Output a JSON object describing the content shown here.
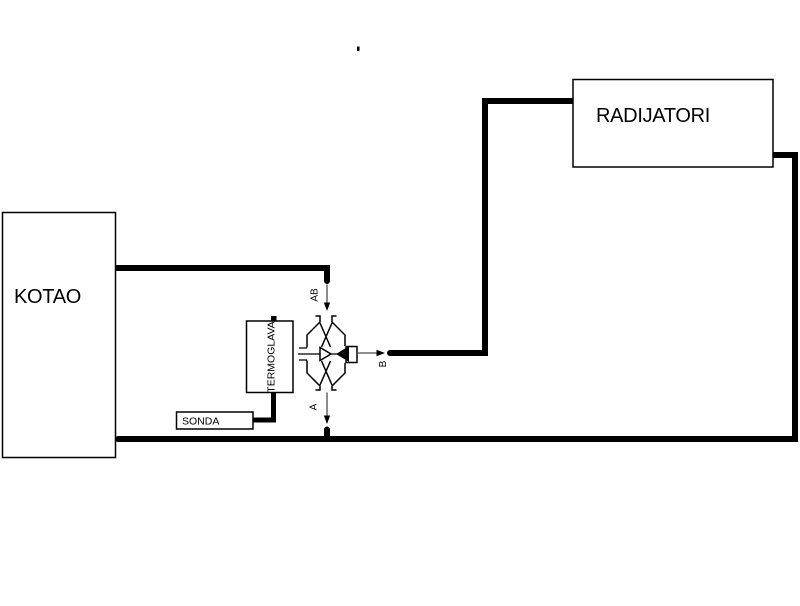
{
  "diagram": {
    "components": {
      "kotao": {
        "label": "KOTAO"
      },
      "radijatori": {
        "label": "RADIJATORI"
      },
      "termoglava": {
        "label": "TERMOGLAVA"
      },
      "sonda": {
        "label": "SONDA"
      }
    },
    "valve": {
      "top_port_label": "AB",
      "bottom_port_label": "A",
      "right_port_label": "B"
    },
    "colors": {
      "line": "#000000",
      "arrow_shaft": "#4d4d4d",
      "background": "#ffffff"
    }
  }
}
